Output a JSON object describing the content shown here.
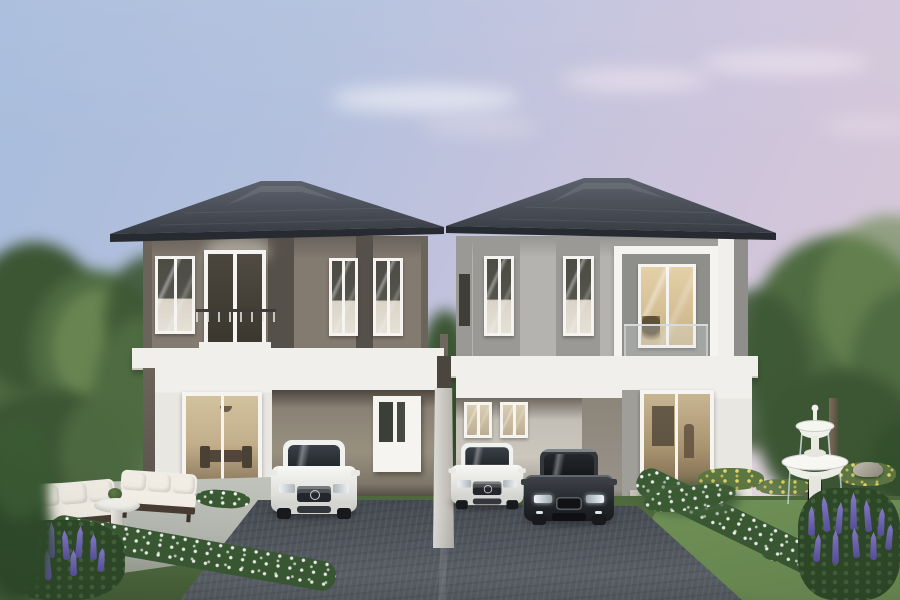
{
  "scene": {
    "type": "architectural-rendering",
    "setting": "Twin two-storey duplex houses at dusk with carports, three cars, garden fountain, outdoor lounge set and flower beds",
    "objects": [
      "evening-sky",
      "clouds",
      "background-trees",
      "left-house",
      "right-house",
      "divider-column",
      "left-driveway",
      "right-driveway",
      "white-suv-left",
      "white-suv-right",
      "dark-sedan",
      "patio",
      "outdoor-sofa-left",
      "outdoor-sofa-right",
      "round-pedestal-table",
      "topiary-planter",
      "garden-fountain",
      "lawn",
      "white-flower-hedges",
      "yellow-flower-bushes",
      "purple-lupine-flowers",
      "garden-rock",
      "tree-trunk"
    ],
    "houses": {
      "left": {
        "storeys": 2,
        "upper_wall": "taupe-grey",
        "roof": "dark-slate-hip",
        "features": [
          "balcony-french-door",
          "three-windows",
          "carport",
          "sliding-glass-door",
          "entry-door"
        ]
      },
      "right": {
        "storeys": 2,
        "upper_wall": "light-grey",
        "roof": "dark-slate-hip",
        "features": [
          "glass-railed-balcony-window-lit",
          "two-windows",
          "carport-two-cars",
          "glass-entry-door"
        ]
      }
    },
    "cars": [
      {
        "name": "white-suv-left",
        "color_key": "car_white"
      },
      {
        "name": "white-suv-right",
        "color_key": "car_white"
      },
      {
        "name": "dark-sedan",
        "color_key": "car_dark"
      }
    ]
  },
  "colors": {
    "sky_top": "#a7bcdc",
    "sky_mid": "#c6c3dd",
    "sky_pink": "#d3c6da",
    "tree_dark": "#3c5634",
    "tree_mid": "#4e6b42",
    "tree_light": "#6d8a54",
    "roof_light": "#5d636d",
    "roof_dark": "#383d45",
    "fascia": "#272b31",
    "wall_taupe": "#837a70",
    "wall_taupe_dark": "#6b645b",
    "panel_dark": "#56504a",
    "wall_gray": "#b4b3b0",
    "wall_gray_dark": "#9a9996",
    "band_white": "#f1efeb",
    "lower_white": "#e9e7e2",
    "frame_white": "#f6f4f0",
    "curtain": "#d9d3c8",
    "glow_warm": "#e4d0a8",
    "interior_warm": "#c2ae8a",
    "drive_light": "#5d636b",
    "drive_dark": "#43484f",
    "grass": "#5a7847",
    "lawn": "#6f9156",
    "hedge": "#3a5a33",
    "flower_white": "#f4f6ee",
    "flower_yellow": "#e4d468",
    "flower_purple": "#8b7fd2",
    "flower_purple_dark": "#5a519f",
    "patio": "#b7bab2",
    "fountain_white": "#f3f3ef",
    "fountain_shade": "#c7c7c0",
    "car_white": "#f1f1ef",
    "car_dark": "#2c2f33",
    "sofa_white": "#efede6",
    "sofa_frame": "#473d33"
  }
}
